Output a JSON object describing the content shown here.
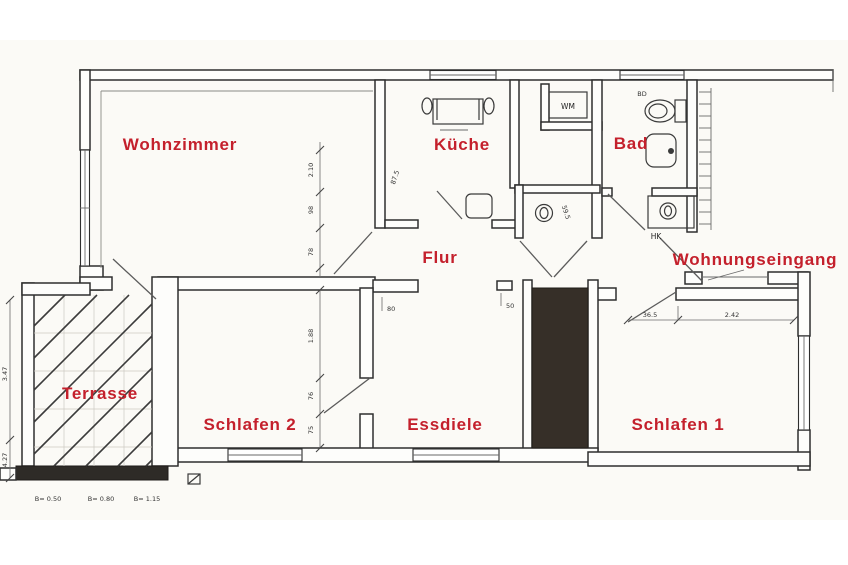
{
  "plan": {
    "rooms": {
      "wohnzimmer": "Wohnzimmer",
      "kueche": "Küche",
      "bad": "Bad",
      "flur": "Flur",
      "wohnungseingang": "Wohnungseingang",
      "terrasse": "Terrasse",
      "schlafen2": "Schlafen 2",
      "essdiele": "Essdiele",
      "schlafen1": "Schlafen 1"
    },
    "label_color": "#c4202c",
    "fixtures": {
      "washing_machine": "WM",
      "radiator": "HK",
      "bidet": "BD"
    },
    "dimensions": {
      "wc_width": "59.5",
      "kitchen_door": "87.5",
      "left_chain": [
        "2.10",
        "98",
        "78",
        "1.88",
        "76",
        "75"
      ],
      "terrace_parapets": [
        "B= 0.50",
        "B= 0.80",
        "B= 1.15"
      ],
      "terrace_side": [
        "3.47",
        "4.27"
      ],
      "schlafen1_widths": [
        "36.5",
        "2.42"
      ],
      "essdiele_marks": [
        "80",
        "50"
      ]
    }
  }
}
